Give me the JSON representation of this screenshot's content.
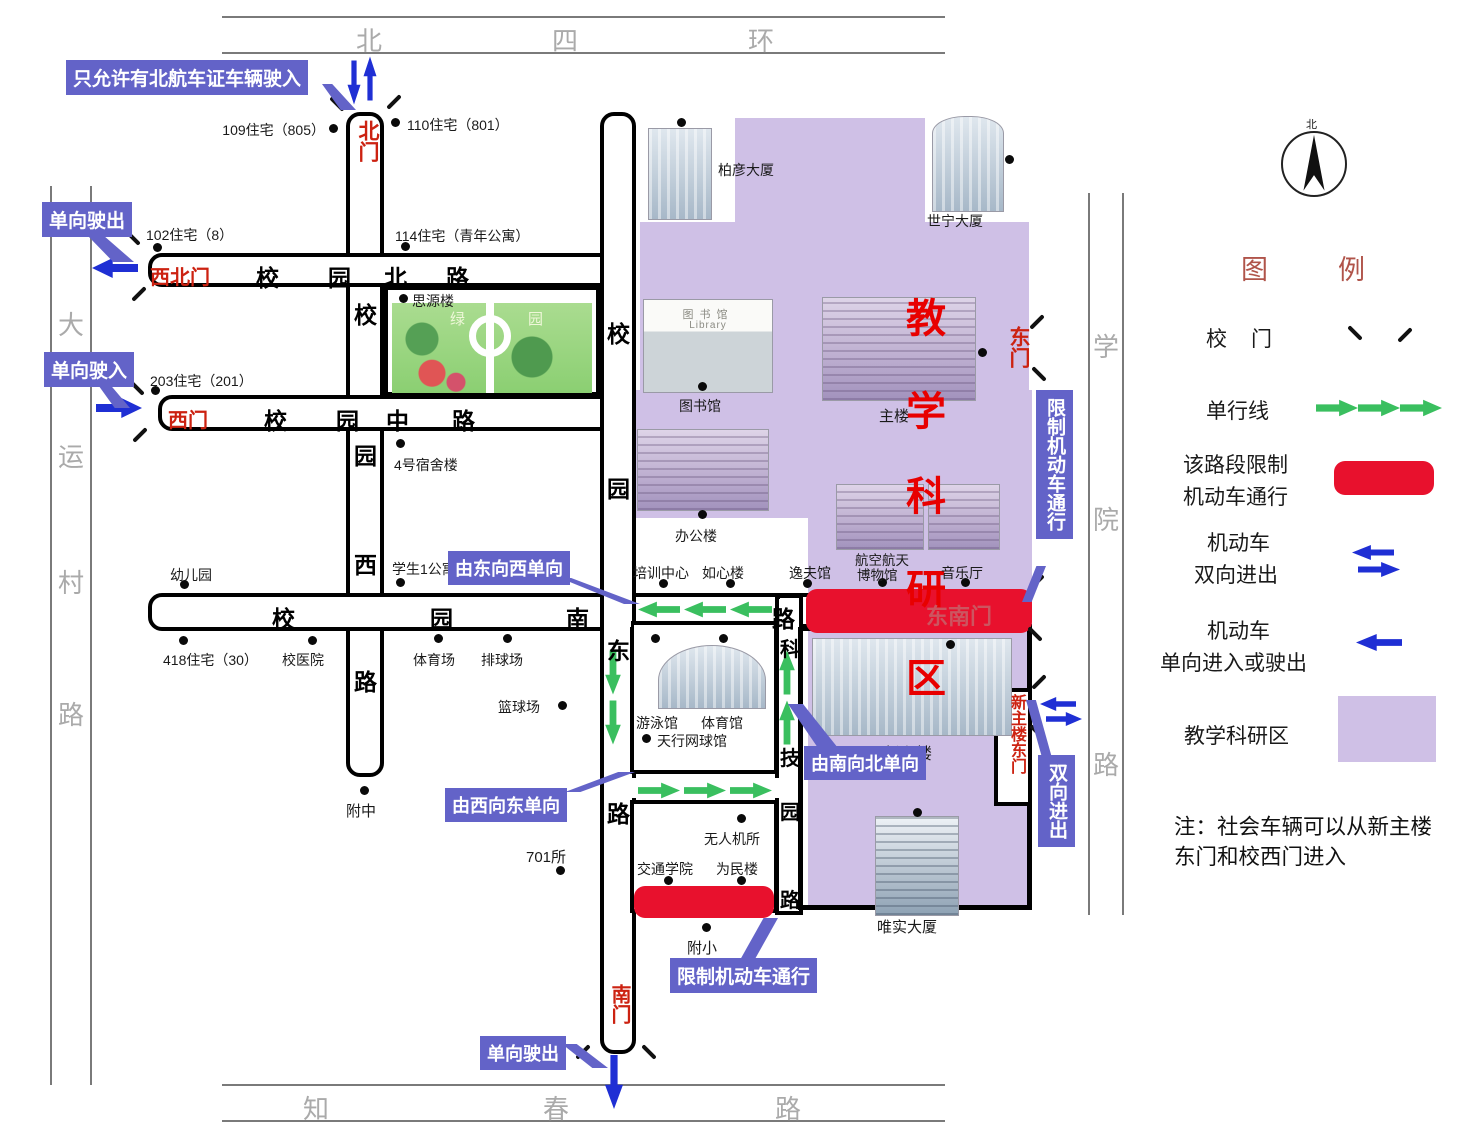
{
  "colors": {
    "annotation_blue": "#6363c8",
    "restricted_red": "#e8112d",
    "zone_purple": "#cfc0e6",
    "one_way_green": "#3abf5f",
    "motor_blue": "#1f2fd4",
    "gate_red": "#cc2211",
    "zone_char_red": "#e80000",
    "legend_title_red": "#b0544a"
  },
  "outer_roads": {
    "north": [
      "北",
      "四",
      "环"
    ],
    "south": [
      "知",
      "春",
      "路"
    ],
    "west": [
      "大",
      "运",
      "村",
      "路"
    ],
    "east": [
      "学",
      "院",
      "路"
    ]
  },
  "campus_roads": {
    "north": [
      "校",
      "园",
      "北",
      "路"
    ],
    "middle": [
      "校",
      "园",
      "中",
      "路"
    ],
    "south": [
      "校",
      "园",
      "南",
      "路"
    ],
    "west": [
      "校",
      "园",
      "西",
      "路"
    ],
    "east": [
      "校",
      "园",
      "东",
      "路"
    ],
    "science": [
      "科",
      "技",
      "园",
      "路"
    ]
  },
  "gates": {
    "north": "北门",
    "northwest": "西北门",
    "west": "西门",
    "south": "南门",
    "east": "东门",
    "southeast": "东南门",
    "new_main_east": "新主楼东门"
  },
  "zone_chars": [
    "教",
    "学",
    "科",
    "研",
    "区"
  ],
  "labels": {
    "res109": "109住宅（805）",
    "res110": "110住宅（801）",
    "res114": "114住宅（青年公寓）",
    "res102": "102住宅（8）",
    "res203": "203住宅（201）",
    "res418": "418住宅（30）",
    "siyuan": "思源楼",
    "dorm4": "4号宿舍楼",
    "student1": "学生1公寓",
    "kindergarten": "幼儿园",
    "hospital": "校医院",
    "stadium": "体育场",
    "volleyball": "排球场",
    "basketball": "篮球场",
    "middle_school": "附中",
    "inst701": "701所",
    "swim": "游泳馆",
    "gym": "体育馆",
    "tennis": "天行网球馆",
    "uav": "无人机所",
    "transport": "交通学院",
    "weimin": "为民楼",
    "primary": "附小",
    "baiyan": "柏彦大厦",
    "shining": "世宁大厦",
    "library": "图书馆",
    "library_en": "Library",
    "main_bldg": "主楼",
    "office": "办公楼",
    "training": "培训中心",
    "ruxin": "如心楼",
    "yifu": "逸夫馆",
    "aviation1": "航空航天",
    "aviation2": "博物馆",
    "concert": "音乐厅",
    "new_main": "新主楼",
    "weishi": "唯实大厦",
    "green1": "绿",
    "green2": "园"
  },
  "annotations": {
    "north_gate_rule": "只允许有北航车证车辆驶入",
    "nw_exit": "单向驶出",
    "w_enter": "单向驶入",
    "e2w": "由东向西单向",
    "w2e": "由西向东单向",
    "s2n": "由南向北单向",
    "restrict_east": "限制机动车通行",
    "two_way": "双向进出",
    "restrict_south": "限制机动车通行",
    "s_exit": "单向驶出"
  },
  "legend": {
    "title": [
      "图",
      "例"
    ],
    "compass_north": "北",
    "rows": {
      "gate": [
        "校",
        "门"
      ],
      "one_way": "单行线",
      "restrict": [
        "该路段限制",
        "机动车通行"
      ],
      "motor_two_way": [
        "机动车",
        "双向进出"
      ],
      "motor_one_way": [
        "机动车",
        "单向进入或驶出"
      ],
      "zone": "教学科研区"
    },
    "note": [
      "注：社会车辆可以从新主楼",
      "东门和校西门进入"
    ]
  }
}
